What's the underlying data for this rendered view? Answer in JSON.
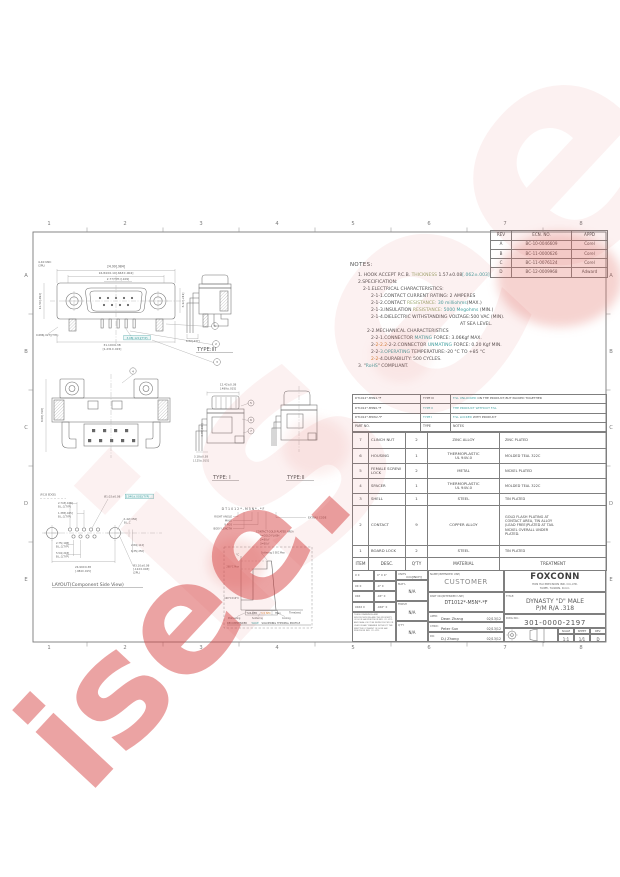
{
  "watermark": {
    "text": "isee.",
    "color": "#d63e3e"
  },
  "border": {
    "columns": [
      "1",
      "2",
      "3",
      "4",
      "5",
      "6",
      "7",
      "8"
    ],
    "rows": [
      "A",
      "B",
      "C",
      "D",
      "E"
    ]
  },
  "revision_table": {
    "headers": [
      "REV",
      "ECN. NO.",
      "APPD"
    ],
    "rows": [
      [
        "A",
        "BC-10-0046609",
        "Corel"
      ],
      [
        "B",
        "BC-11-0000626",
        "Corel"
      ],
      [
        "C",
        "BC-11-0076124",
        "Corel"
      ],
      [
        "D",
        "BC-12-0009968",
        "Adward"
      ]
    ]
  },
  "notes": {
    "title": "NOTES:",
    "lines": [
      {
        "ind": 8,
        "segs": [
          [
            "1. HOOK ACCEPT P.C.B. ",
            ""
          ],
          [
            "THICKNESS",
            "g"
          ],
          [
            " 1.57±0.08",
            ""
          ],
          [
            "[.062±.003]",
            "t"
          ]
        ]
      },
      {
        "ind": 8,
        "segs": [
          [
            "2.SPECIFICATION:",
            ""
          ]
        ]
      },
      {
        "ind": 13,
        "segs": [
          [
            "2-1.ELECTRICAL CHARACTERISTICS:",
            ""
          ]
        ]
      },
      {
        "ind": 21,
        "segs": [
          [
            "2-1-1.CONTACT CURRENT RATING: 2  AMPERES",
            ""
          ]
        ]
      },
      {
        "ind": 21,
        "segs": [
          [
            "2-1-2.CONTACT ",
            ""
          ],
          [
            "RESISTANCE:",
            "g"
          ],
          [
            " ",
            ""
          ],
          [
            "30 milliohms",
            "t"
          ],
          [
            "(MAX.)",
            ""
          ]
        ]
      },
      {
        "ind": 21,
        "segs": [
          [
            "2-1-3.INSULATION ",
            ""
          ],
          [
            "RESISTANCE:",
            "g"
          ],
          [
            " ",
            ""
          ],
          [
            "5000 Megohms",
            "t"
          ],
          [
            " (MIN.)",
            ""
          ]
        ]
      },
      {
        "ind": 21,
        "segs": [
          [
            "2-1-4.DIELECTRIC WITHSTANDING VOLTAGE:500 VAC (MIN).",
            ""
          ]
        ]
      },
      {
        "ind": 110,
        "segs": [
          [
            "AT SEA LEVEL.",
            ""
          ]
        ]
      },
      {
        "ind": 17,
        "segs": [
          [
            "2-2.MECHANICAL CHARACTERISTICS",
            ""
          ]
        ]
      },
      {
        "ind": 21,
        "segs": [
          [
            "2-2-1.CONNECTOR ",
            ""
          ],
          [
            "MATING",
            "t"
          ],
          [
            " FORCE:  3.06Kgf MAX.",
            ""
          ]
        ]
      },
      {
        "ind": 21,
        "segs": [
          [
            "2-",
            ""
          ],
          [
            "2-2.2",
            "o"
          ],
          [
            "-2-2.CONNECTOR ",
            ""
          ],
          [
            "UNMATING",
            "t"
          ],
          [
            " FORCE:  0.20 Kgf MIN.",
            ""
          ]
        ]
      },
      {
        "ind": 21,
        "segs": [
          [
            "2-2-",
            ""
          ],
          [
            "3.OPERATING",
            "t"
          ],
          [
            " TEMPERATURE:-20 °C TO +85 °C",
            ""
          ]
        ]
      },
      {
        "ind": 21,
        "segs": [
          [
            "2-2-",
            "o"
          ],
          [
            "4.DURABILITY:  500  CYCLES.",
            ""
          ]
        ]
      },
      {
        "ind": 8,
        "segs": [
          [
            "3. \"",
            ""
          ],
          [
            "RoHS",
            "t"
          ],
          [
            "\" COMPLIANT.",
            ""
          ]
        ]
      }
    ]
  },
  "type_table": {
    "rows": [
      {
        "pn": "DT1012*-M5N2-*F",
        "type": "TYPE III",
        "type_cls": "",
        "note": [
          [
            "F.SL UNLOCKED",
            "t"
          ],
          [
            " ON THE PRODUCT,BUT PACKED TOGETHER",
            ""
          ]
        ]
      },
      {
        "pn": "DT1012*-M5N0-*F",
        "type": "TYPE II",
        "type_cls": "t",
        "note": [
          [
            "THE PRODUCT WITHOUT F.SL",
            "t"
          ]
        ]
      },
      {
        "pn": "DT1012*-M5W2-*F",
        "type": "TYPE I",
        "type_cls": "t",
        "note": [
          [
            "F.SL LOCKED",
            "t"
          ],
          [
            " WITH PRODUCT",
            ""
          ]
        ]
      }
    ],
    "header": [
      "PART NO.",
      "TYPE",
      "NOTES"
    ]
  },
  "parts_table": {
    "header": [
      "ITEM",
      "DESC.",
      "Q'TY",
      "MATERIAL",
      "TREATMENT"
    ],
    "rows": [
      {
        "item": "7",
        "desc": "CLINCH NUT",
        "qty": "2",
        "material": "ZINC ALLOY",
        "treatment": "ZINC PLATED"
      },
      {
        "item": "6",
        "desc": "HOUSING",
        "qty": "1",
        "material": "THERMOPLASTIC\nUL 94V-0",
        "treatment": "MOLDED  TEAL  322C"
      },
      {
        "item": "5",
        "desc": "FEMALE SCREW\nLOCK",
        "qty": "2",
        "material": "METAL",
        "treatment": "NICKEL PLATED"
      },
      {
        "item": "4",
        "desc": "SPACER",
        "qty": "1",
        "material": "THERMOPLASTIC\nUL 94V-0",
        "treatment": "MOLDED  TEAL  322C"
      },
      {
        "item": "3",
        "desc": "SHELL",
        "qty": "1",
        "material": "STEEL",
        "treatment": "TIN PLATED"
      },
      {
        "item": "2",
        "desc": "CONTACT",
        "qty": "9",
        "material": "COPPER ALLOY",
        "treatment": "GOLD FLASH  PLATING AT\nCONTACT AREA, TIN ALLOY\n(LEAD FREE)PLATED AT TAIL\nNICKEL OVERALL UNDER\nPLATED."
      },
      {
        "item": "1",
        "desc": "BOARD LOCK",
        "qty": "2",
        "material": "STEEL",
        "treatment": "TIN PLATED"
      }
    ]
  },
  "title_block": {
    "units_label": "UNITS",
    "units_value": "mm[INCH]",
    "matl_label": "MAT'L",
    "matl_value": "N/A",
    "finish_label": "FINISH",
    "finish_value": "N/A",
    "qty_label": "Q'TY",
    "qty_value": "N/A",
    "name_label": "NAME(INTENDED USE)",
    "name_value": "CUSTOMER",
    "part_label": "PART NO(INTENDED USE)",
    "part_value": "DT1012*-M5N*-*F",
    "appd_label": "APPD:",
    "appd_name": "Dean Zhang",
    "appd_date": "02/13/12",
    "chkd_label": "CHKD:",
    "chkd_name": "Peter Sun",
    "chkd_date": "02/13/12",
    "dr_label": "DR:",
    "dr_name": "D.J Zhang",
    "dr_date": "02/13/12",
    "company": "FOXCONN",
    "company_line1": "HON HAI PRECISION IND. CO.,LTD.",
    "company_line2": "TAIPEI, TAIWAN, R.O.C.",
    "title_label": "TITLE:",
    "title_line1": "DYNASTY \"D\" MALE",
    "title_line2": "P/M R/A .318",
    "dwg_label": "DWG NO.:",
    "dwg_value": "301-0000-2197",
    "scale_label": "SCALE",
    "scale_value": "1:1",
    "sheet_label": "SHEET",
    "sheet_value": "1/1",
    "rev_label": "REV.",
    "rev_value": "D",
    "tol_rows": [
      [
        "X ±",
        "X° ± 4°"
      ],
      [
        "XX ±",
        ".X° ±"
      ],
      [
        "XXX ±0.38[.015]",
        ".XX° ±"
      ],
      [
        "XXXX ±",
        ".XXX° ±"
      ]
    ],
    "disclaimer": "THESE DRAWINGS AND SPECIFICATIONS ARE THE PROPERTY OF HON HAI PRECISION IND. CO.,LTD. AND SHALL NOT BE REPRODUCED OR USED IN ANY MANNER WITHOUT THE WRITTEN CONSENT OF HON HAI PRECISION IND. CO.,LTD."
  },
  "annotations": [
    {
      "x": 116,
      "y": 267.5,
      "t": "24.99[.984]",
      "fs": 3.1,
      "a": "middle"
    },
    {
      "x": 116,
      "y": 274,
      "t": "16.84±0.10[.663±.004]",
      "fs": 2.9,
      "a": "middle"
    },
    {
      "x": 118,
      "y": 280,
      "t": "2.77(TYP.)[.109]",
      "fs": 2.8,
      "a": "middle"
    },
    {
      "x": 38,
      "y": 263,
      "t": "4-40 UNC",
      "fs": 2.8
    },
    {
      "x": 38,
      "y": 266.5,
      "t": "(2PL)",
      "fs": 2.8
    },
    {
      "x": 41,
      "y": 301,
      "t": "12.50[.492]",
      "fs": 2.8,
      "a": "middle",
      "rot": -90
    },
    {
      "x": 184,
      "y": 300,
      "t": "6.12[.241]",
      "fs": 2.8,
      "a": "middle",
      "rot": -90
    },
    {
      "x": 36,
      "y": 336,
      "t": "0.686[.027](TYP.)",
      "fs": 2.6
    },
    {
      "x": 137,
      "y": 338.8,
      "t": "3.08[.121](TYP)",
      "fs": 2.7,
      "a": "middle",
      "cls": "t",
      "box": true
    },
    {
      "x": 112,
      "y": 346,
      "t": "31.19±0.38",
      "fs": 2.9,
      "a": "middle"
    },
    {
      "x": 112,
      "y": 350,
      "t": "[1.231±.015]",
      "fs": 2.8,
      "a": "middle"
    },
    {
      "x": 186,
      "y": 342,
      "t": "6.02[.237]",
      "fs": 2.6
    },
    {
      "x": 215,
      "y": 327.2,
      "t": "1",
      "fs": 3,
      "a": "middle"
    },
    {
      "x": 216,
      "y": 345.2,
      "t": "2",
      "fs": 3,
      "a": "middle"
    },
    {
      "x": 217,
      "y": 363.2,
      "t": "3",
      "fs": 3,
      "a": "middle"
    },
    {
      "x": 197,
      "y": 351,
      "t": "TYPE:III",
      "fs": 5.2,
      "cls": "vl"
    },
    {
      "x": 133,
      "y": 372.3,
      "t": "4",
      "fs": 3,
      "a": "middle"
    },
    {
      "x": 43,
      "y": 415,
      "t": "8.08[.318]",
      "fs": 2.7,
      "a": "middle",
      "rot": -90
    },
    {
      "x": 228,
      "y": 385.5,
      "t": "12.42±0.38",
      "fs": 2.8,
      "a": "middle"
    },
    {
      "x": 228,
      "y": 389.5,
      "t": "[.489±.015]",
      "fs": 2.7,
      "a": "middle"
    },
    {
      "x": 203,
      "y": 430,
      "t": "0.76[.030]",
      "fs": 2.5,
      "a": "middle",
      "rot": -90
    },
    {
      "x": 201,
      "y": 457.5,
      "t": "3.18±0.38",
      "fs": 2.7,
      "a": "middle"
    },
    {
      "x": 201,
      "y": 461.5,
      "t": "[.125±.015]",
      "fs": 2.6,
      "a": "middle"
    },
    {
      "x": 251,
      "y": 404.2,
      "t": "5",
      "fs": 3,
      "a": "middle"
    },
    {
      "x": 251,
      "y": 421.2,
      "t": "6",
      "fs": 3,
      "a": "middle"
    },
    {
      "x": 251,
      "y": 432.2,
      "t": "7",
      "fs": 3,
      "a": "middle"
    },
    {
      "x": 213,
      "y": 479,
      "t": "TYPE: I",
      "fs": 5.2,
      "cls": "vl"
    },
    {
      "x": 287,
      "y": 479,
      "t": "TYPE:II",
      "fs": 5.2,
      "cls": "vl"
    },
    {
      "x": 243,
      "y": 510,
      "t": "D T 1 0 1 2 * - M 5 N * - * F",
      "fs": 3.2,
      "a": "middle"
    },
    {
      "x": 232,
      "y": 517.5,
      "t": "RIGHT ANGLE",
      "fs": 2.6,
      "a": "end"
    },
    {
      "x": 232,
      "y": 521.5,
      "t": "MALE",
      "fs": 2.6,
      "a": "end"
    },
    {
      "x": 232,
      "y": 525.5,
      "t": "9 POS",
      "fs": 2.6,
      "a": "end"
    },
    {
      "x": 232,
      "y": 529.5,
      "t": "BODY LENGTH",
      "fs": 2.6,
      "a": "end"
    },
    {
      "x": 308,
      "y": 518.5,
      "t": "EXTRAS CODE",
      "fs": 2.6
    },
    {
      "x": 256,
      "y": 532.5,
      "t": "CONTACT GOLD PLATED AREA",
      "fs": 2.5
    },
    {
      "x": 260,
      "y": 536.5,
      "t": "*=GOLD FLASH",
      "fs": 2.5
    },
    {
      "x": 260,
      "y": 540.5,
      "t": "2=30u\"",
      "fs": 2.5
    },
    {
      "x": 260,
      "y": 544.5,
      "t": "3=50u\"",
      "fs": 2.5
    },
    {
      "x": 40,
      "y": 495.5,
      "t": "(P.C.B EDGE)",
      "fs": 2.5
    },
    {
      "x": 104,
      "y": 497.5,
      "t": "Ø1.02±0.08",
      "fs": 2.7
    },
    {
      "x": 126,
      "y": 497.5,
      "t": "[.040±.003](TYP)",
      "fs": 2.7,
      "cls": "t",
      "box": true
    },
    {
      "x": 58,
      "y": 504,
      "t": "2.743[.108]",
      "fs": 2.5
    },
    {
      "x": 58,
      "y": 507.5,
      "t": "B.L.C(TYP)",
      "fs": 2.5
    },
    {
      "x": 58,
      "y": 514,
      "t": "1.385[.045]",
      "fs": 2.5
    },
    {
      "x": 58,
      "y": 517.5,
      "t": "B.L.C(TYP)",
      "fs": 2.5
    },
    {
      "x": 124,
      "y": 520,
      "t": "1.42[.056]",
      "fs": 2.5
    },
    {
      "x": 124,
      "y": 523.5,
      "t": "B.L.C",
      "fs": 2.5
    },
    {
      "x": 56,
      "y": 544,
      "t": "2.75[.108]",
      "fs": 2.5
    },
    {
      "x": 56,
      "y": 547.5,
      "t": "B.L.C(TYP)",
      "fs": 2.5
    },
    {
      "x": 56,
      "y": 554,
      "t": "5.54[.218]",
      "fs": 2.5
    },
    {
      "x": 56,
      "y": 557.5,
      "t": "B.L.C(TYP)",
      "fs": 2.5
    },
    {
      "x": 131,
      "y": 546,
      "t": "2.84[.112]",
      "fs": 2.5
    },
    {
      "x": 131,
      "y": 552,
      "t": "6.35[.250]",
      "fs": 2.5
    },
    {
      "x": 83,
      "y": 568,
      "t": "24.99±0.38",
      "fs": 2.7,
      "a": "middle"
    },
    {
      "x": 83,
      "y": 572,
      "t": "[.984±.015]",
      "fs": 2.6,
      "a": "middle"
    },
    {
      "x": 133,
      "y": 566.5,
      "t": "Ø3.10±0.08",
      "fs": 2.7
    },
    {
      "x": 133,
      "y": 570,
      "t": "[.122±.003]",
      "fs": 2.7
    },
    {
      "x": 133,
      "y": 573.5,
      "t": "(2PL)",
      "fs": 2.7
    },
    {
      "x": 52,
      "y": 586,
      "t": "LAYOUT(Component Side View)",
      "fs": 4.6,
      "cls": "vl"
    },
    {
      "x": 261,
      "y": 553.5,
      "t": "Soldering 5 SEC Max",
      "fs": 2.3
    },
    {
      "x": 239,
      "y": 555.5,
      "t": "°C",
      "fs": 2.5,
      "a": "end"
    },
    {
      "x": 239,
      "y": 567.5,
      "t": "260°C Max",
      "fs": 2.3,
      "a": "end"
    },
    {
      "x": 239,
      "y": 599,
      "t": "100°C±10°C",
      "fs": 2.3,
      "a": "end"
    },
    {
      "x": 289,
      "y": 613.5,
      "t": "Time(sec)",
      "fs": 2.5
    },
    {
      "x": 247,
      "y": 614.2,
      "t": "SOLDER",
      "fs": 2.5
    },
    {
      "x": 261,
      "y": 614.2,
      "t": "3-5 SEC",
      "fs": 2.5,
      "cls": "o"
    },
    {
      "x": 275.5,
      "y": 614.2,
      "t": "Max",
      "fs": 2.5
    },
    {
      "x": 228,
      "y": 618.8,
      "t": "Preheating",
      "fs": 2.3
    },
    {
      "x": 252,
      "y": 618.8,
      "t": "Soldering",
      "fs": 2.3
    },
    {
      "x": 282,
      "y": 618.8,
      "t": "Cooling",
      "fs": 2.3
    },
    {
      "x": 227,
      "y": 623.8,
      "t": "RECOMMENDED",
      "fs": 2.5
    },
    {
      "x": 251.5,
      "y": 623.8,
      "t": "WAVE",
      "fs": 2.5,
      "cls": "t"
    },
    {
      "x": 261.5,
      "y": 623.8,
      "t": "SOLDERING THERMAL PROFILE",
      "fs": 2.5
    }
  ]
}
